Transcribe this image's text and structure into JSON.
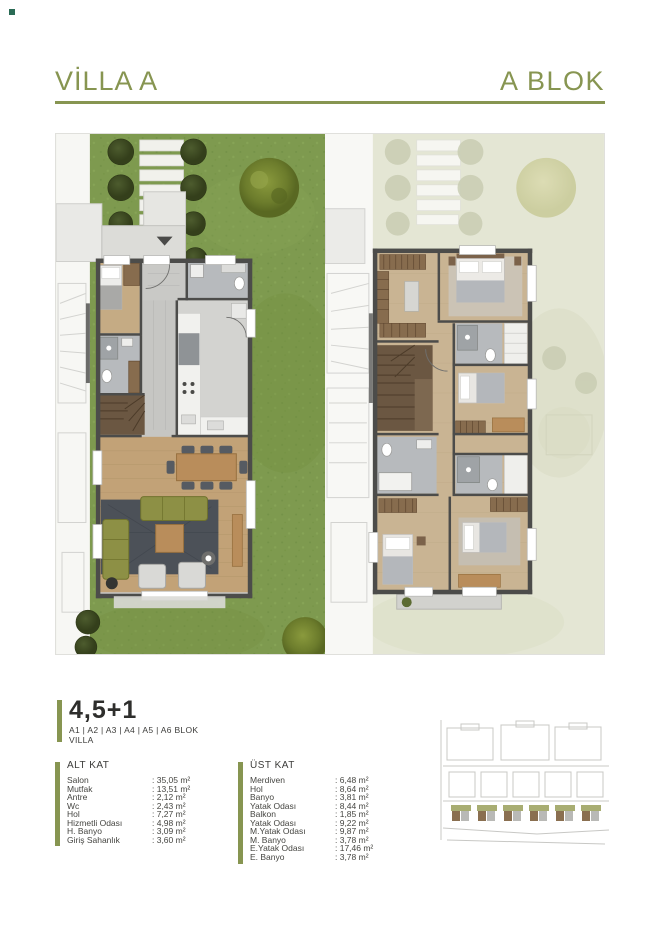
{
  "page": {
    "accent_color": "#879551",
    "corner_dot_color": "#2a6b55",
    "background": "#ffffff"
  },
  "header": {
    "left_title": "VİLLA A",
    "right_title": "A BLOK"
  },
  "unit": {
    "type_label": "4,5+1",
    "blocks_label": "A1 | A2 | A3 | A4 | A5 | A6 BLOK",
    "category_label": "VILLA"
  },
  "floor_tables": {
    "lower": {
      "title": "ALT KAT",
      "rows": [
        {
          "label": "Salon",
          "value": ": 35,05 m²"
        },
        {
          "label": "Mutfak",
          "value": ": 13,51 m²"
        },
        {
          "label": "Antre",
          "value": ": 2,12 m²"
        },
        {
          "label": "Wc",
          "value": ": 2,43 m²"
        },
        {
          "label": "Hol",
          "value": ": 7,27 m²"
        },
        {
          "label": "Hizmetli Odası",
          "value": ": 4,98 m²"
        },
        {
          "label": "H. Banyo",
          "value": ": 3,09 m²"
        },
        {
          "label": "Giriş Sahanlık",
          "value": ": 3,60 m²"
        }
      ]
    },
    "upper": {
      "title": "ÜST KAT",
      "rows": [
        {
          "label": "Merdiven",
          "value": ": 6,48 m²"
        },
        {
          "label": "Hol",
          "value": ": 8,64 m²"
        },
        {
          "label": "Banyo",
          "value": ": 3,81 m²"
        },
        {
          "label": "Yatak Odası",
          "value": ": 8,44 m²"
        },
        {
          "label": "Balkon",
          "value": ": 1,85 m²"
        },
        {
          "label": "Yatak Odası",
          "value": ": 9,22 m²"
        },
        {
          "label": "M.Yatak Odası",
          "value": ": 9,87 m²"
        },
        {
          "label": "M. Banyo",
          "value": ": 3,78 m²"
        },
        {
          "label": "E.Yatak Odası",
          "value": ": 17,46 m²"
        },
        {
          "label": "E. Banyo",
          "value": ": 3,78 m²"
        }
      ]
    }
  }
}
